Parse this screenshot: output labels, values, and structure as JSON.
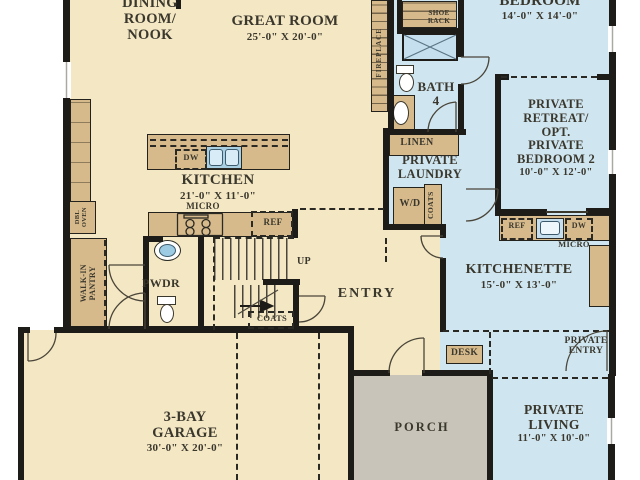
{
  "colors": {
    "floor_main": "#f4e7c3",
    "floor_suite": "#cfe5f0",
    "floor_porch": "#c8c4b9",
    "cabinet_tan": "#d6ba8c",
    "wall_black": "#1d1c19",
    "text": "#3a372d",
    "sink_blue": "#c6dfee"
  },
  "rooms": {
    "dining": {
      "line1": "DINING",
      "line2": "ROOM/",
      "line3": "NOOK"
    },
    "great_room": {
      "name": "GREAT ROOM",
      "dims": "25'-0\" X 20'-0\""
    },
    "bedroom": {
      "name": "BEDROOM",
      "dims": "14'-0\" X 14'-0\""
    },
    "private_retreat": {
      "line1": "PRIVATE",
      "line2": "RETREAT/",
      "line3": "OPT.",
      "line4": "PRIVATE",
      "line5": "BEDROOM 2",
      "dims": "10'-0\" X 12'-0\""
    },
    "bath4": {
      "line1": "BATH",
      "line2": "4"
    },
    "private_laundry": {
      "line1": "PRIVATE",
      "line2": "LAUNDRY"
    },
    "kitchen": {
      "name": "KITCHEN",
      "dims": "21'-0\" X 11'-0\""
    },
    "kitchenette": {
      "name": "KITCHENETTE",
      "dims": "15'-0\" X 13'-0\""
    },
    "entry": {
      "name": "ENTRY"
    },
    "pwdr": {
      "name": "PWDR"
    },
    "walk_in_pantry": {
      "line1": "WALK-IN",
      "line2": "PANTRY"
    },
    "garage": {
      "line1": "3-BAY",
      "line2": "GARAGE",
      "dims": "30'-0\" X 20'-0\""
    },
    "porch": {
      "name": "PORCH"
    },
    "private_living": {
      "line1": "PRIVATE",
      "line2": "LIVING",
      "dims": "11'-0\" X 10'-0\""
    },
    "private_entry": {
      "line1": "PRIVATE",
      "line2": "ENTRY"
    }
  },
  "fixtures": {
    "fireplace": "FIREPLACE",
    "shoe_rack_line1": "SHOE",
    "shoe_rack_line2": "RACK",
    "linen": "LINEN",
    "washer_dryer": "W/D",
    "coats_laundry": "COATS",
    "coats_entry": "COATS",
    "island_dishwasher": "DW",
    "kitchen_micro": "MICRO",
    "kitchen_ref": "REF",
    "dbl_oven_line1": "DBL",
    "dbl_oven_line2": "OVEN",
    "kitchenette_ref": "REF",
    "kitchenette_dw": "DW",
    "kitchenette_micro": "MICRO",
    "desk": "DESK",
    "stairs_up": "UP"
  }
}
